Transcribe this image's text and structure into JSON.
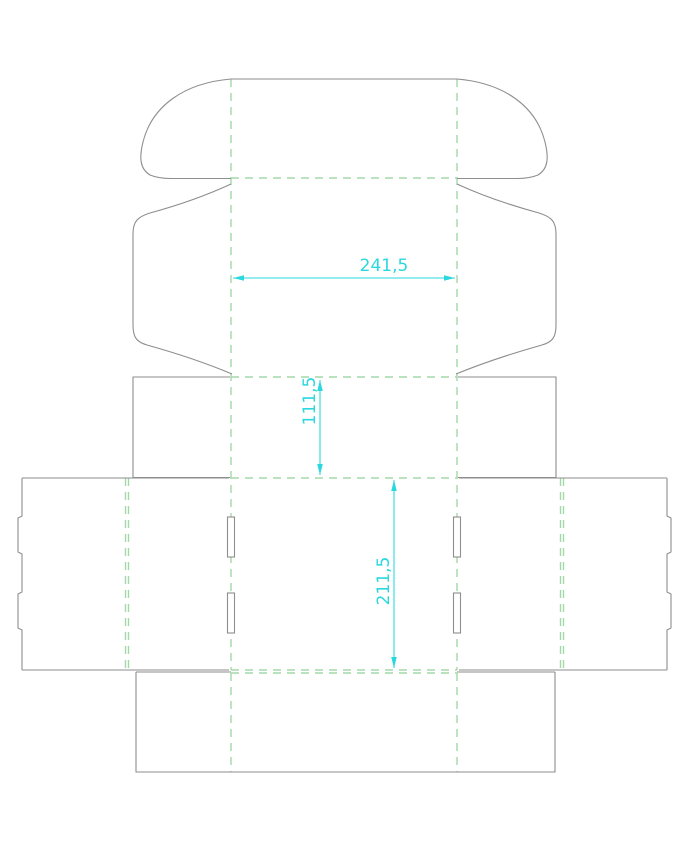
{
  "drawing": {
    "kind": "box packaging dieline",
    "dimensions": [
      {
        "label": "241,5",
        "orientation": "horizontal"
      },
      {
        "label": "111,5",
        "orientation": "vertical"
      },
      {
        "label": "211,5",
        "orientation": "vertical"
      }
    ]
  },
  "colors": {
    "background": "#ffffff",
    "cut": "#8e8e8e",
    "fold": "#a3d9a8",
    "dim": "#2bd8de"
  }
}
